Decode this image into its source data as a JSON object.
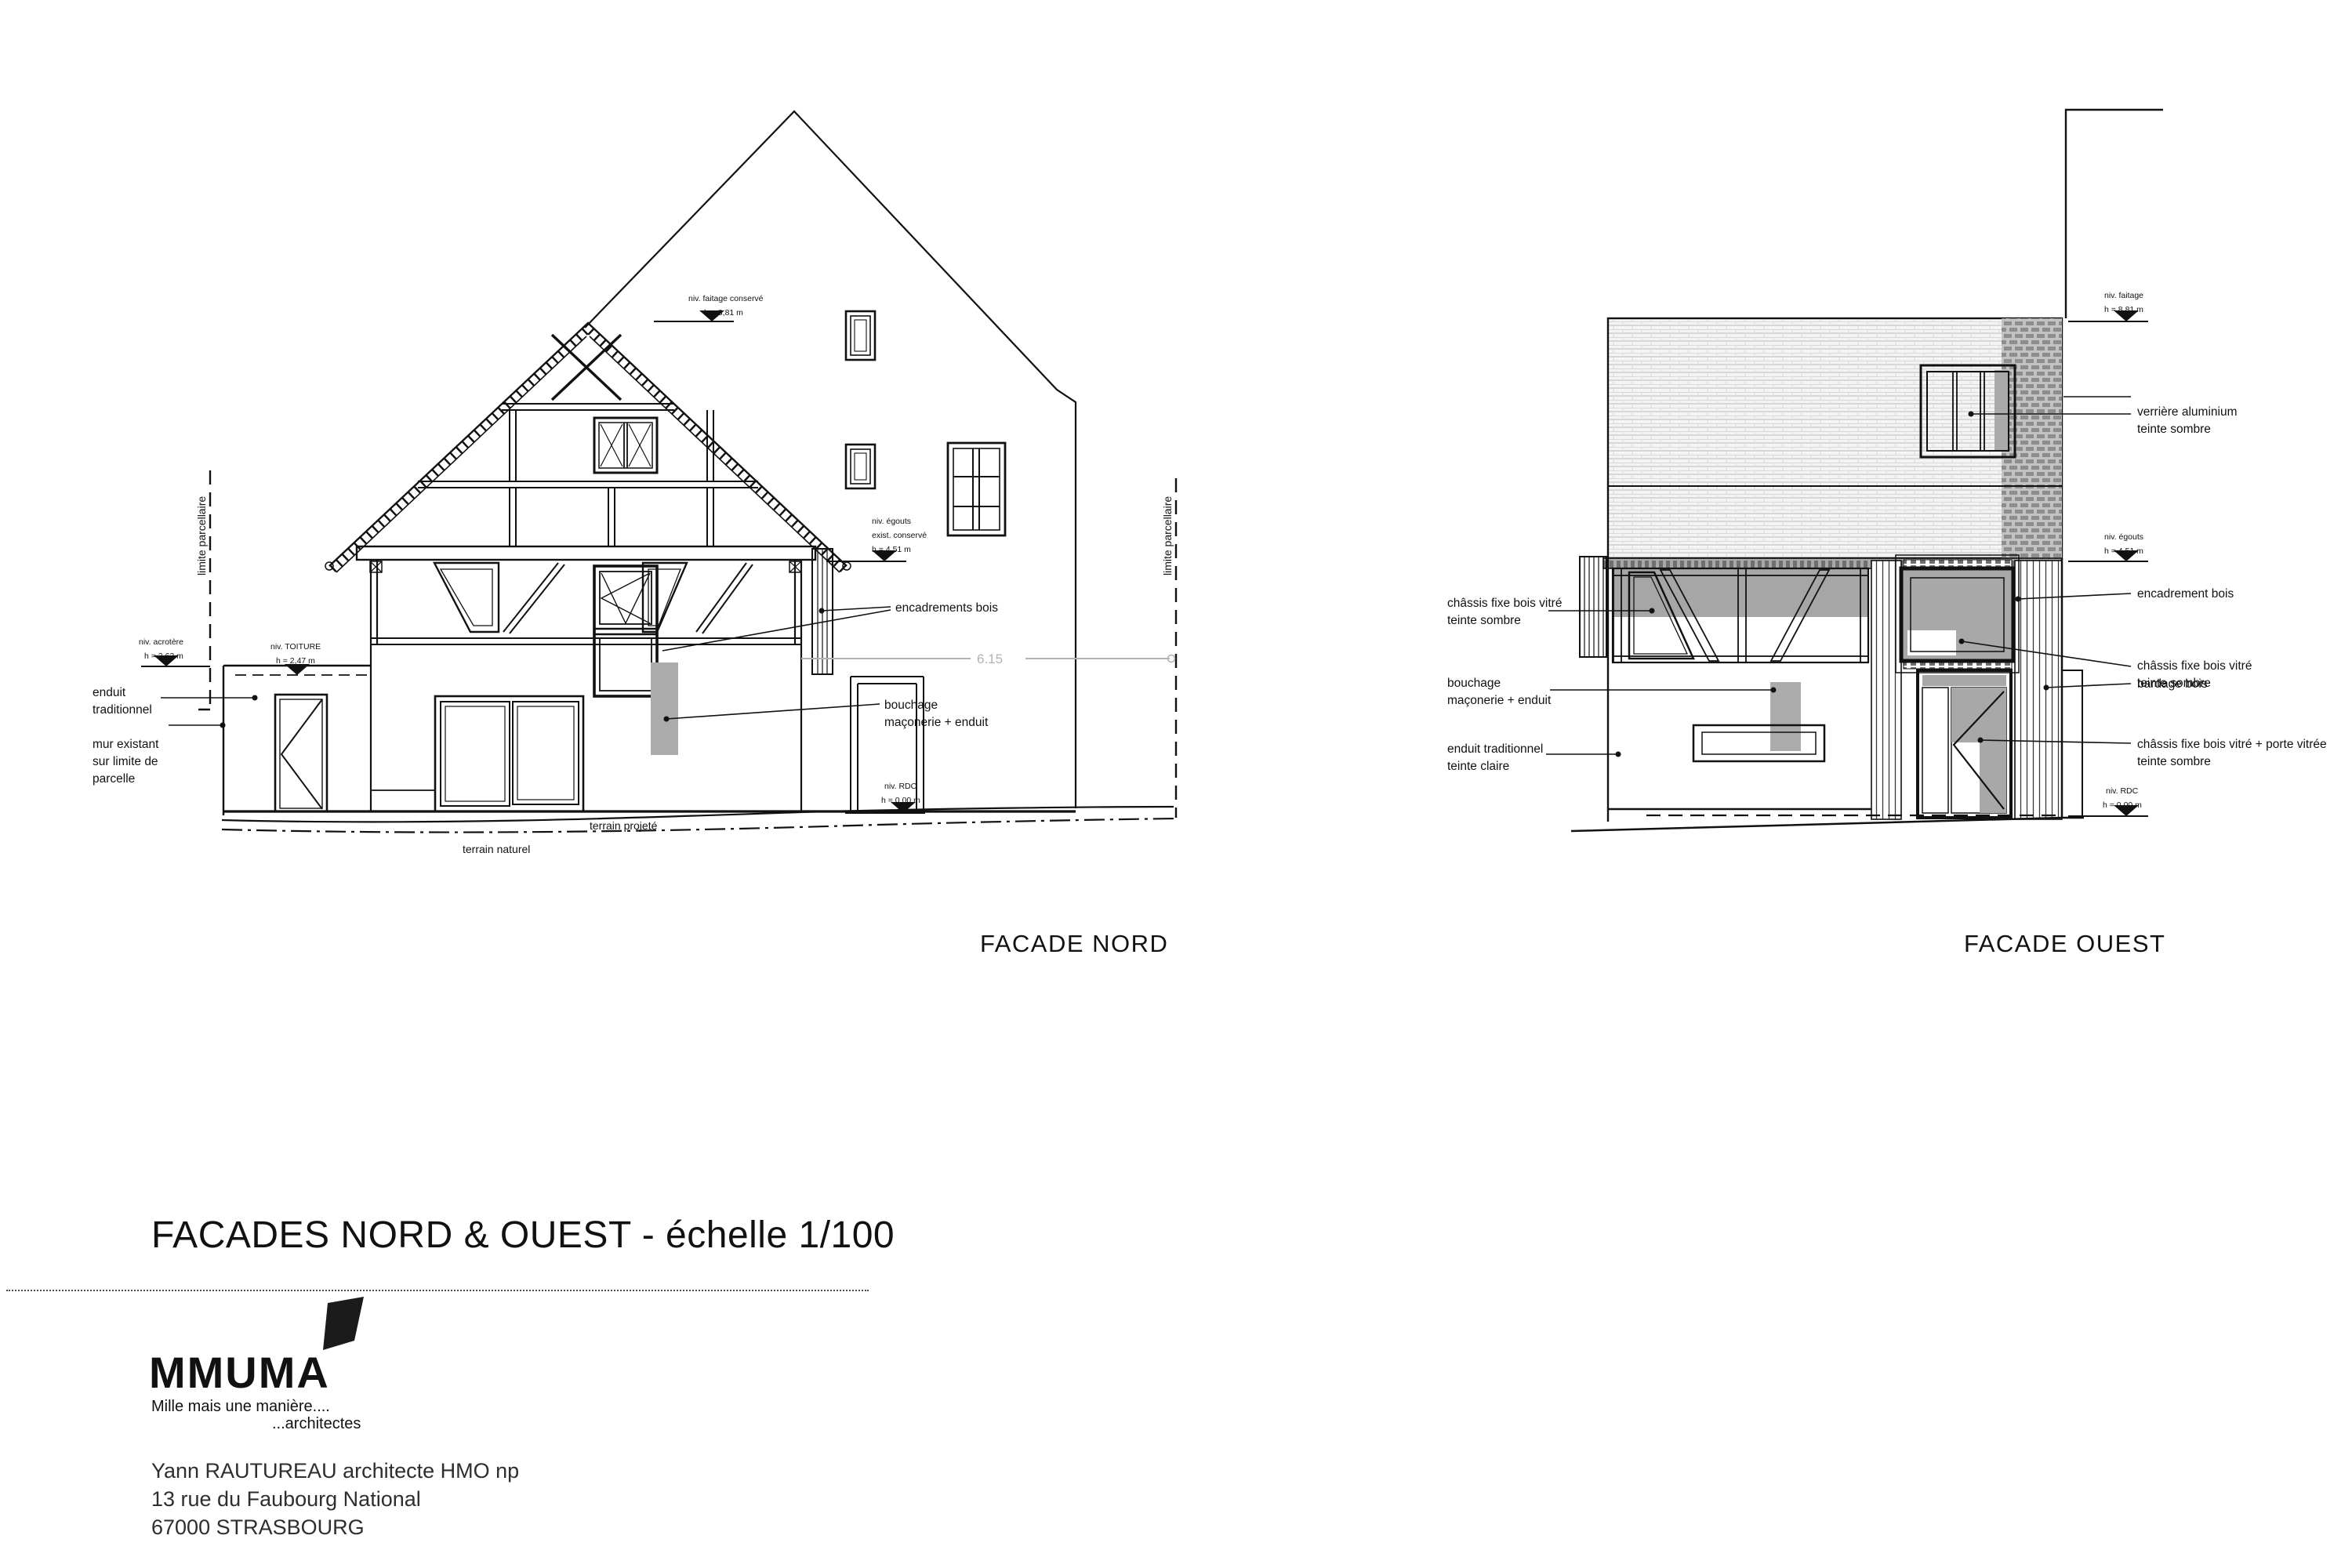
{
  "title": "FACADES NORD & OUEST - échelle 1/100",
  "facade_nord": {
    "caption": "FACADE NORD",
    "levels": {
      "faitage_l1": "niv. faitage conservé",
      "faitage_l2": "h = 8,81 m",
      "egouts_l1": "niv. égouts",
      "egouts_l2": "exist. conservé",
      "egouts_l3": "h = 4,51 m",
      "rdc_l1": "niv. RDC",
      "rdc_l2": "h = 0.00 m",
      "acrotere_l1": "niv. acrotère",
      "acrotere_l2": "h = 2,62 m",
      "toiture_l1": "niv. TOITURE",
      "toiture_l2": "h = 2,47 m"
    },
    "labels": {
      "enduit_l1": "enduit",
      "enduit_l2": "traditionnel",
      "mur_l1": "mur existant",
      "mur_l2": "sur limite de",
      "mur_l3": "parcelle",
      "encadrements": "encadrements bois",
      "bouchage_l1": "bouchage",
      "bouchage_l2": "maçonerie + enduit",
      "terrain_projete": "terrain projeté",
      "terrain_naturel": "terrain naturel",
      "limite_gauche": "limite parcellaire",
      "limite_droite": "limite parcellaire",
      "dimension": "6.15"
    }
  },
  "facade_ouest": {
    "caption": "FACADE OUEST",
    "levels": {
      "faitage_l1": "niv. faitage",
      "faitage_l2": "h = 8,81 m",
      "egouts_l1": "niv. égouts",
      "egouts_l2": "h = 4,51 m",
      "rdc_l1": "niv. RDC",
      "rdc_l2": "h = 0.00 m"
    },
    "labels": {
      "chassis_gauche_l1": "châssis fixe bois vitré",
      "chassis_gauche_l2": "teinte sombre",
      "bouchage_l1": "bouchage",
      "bouchage_l2": "maçonerie + enduit",
      "enduit_l1": "enduit traditionnel",
      "enduit_l2": "teinte claire",
      "verriere_l1": "verrière aluminium",
      "verriere_l2": "teinte sombre",
      "encadrement": "encadrement bois",
      "chassis_droit_l1": "châssis fixe bois vitré",
      "chassis_droit_l2": "teinte sombre",
      "bardage": "bardage bois",
      "chassis_porte_l1": "châssis fixe bois vitré + porte vitrée",
      "chassis_porte_l2": "teinte sombre"
    }
  },
  "title_block": {
    "logo_text": "MMUMA",
    "tagline_1": "Mille mais une manière....",
    "tagline_2": "...architectes",
    "architect_line": "Yann RAUTUREAU architecte HMO np",
    "address_line": "13 rue du Faubourg National",
    "city_line": "67000 STRASBOURG"
  }
}
